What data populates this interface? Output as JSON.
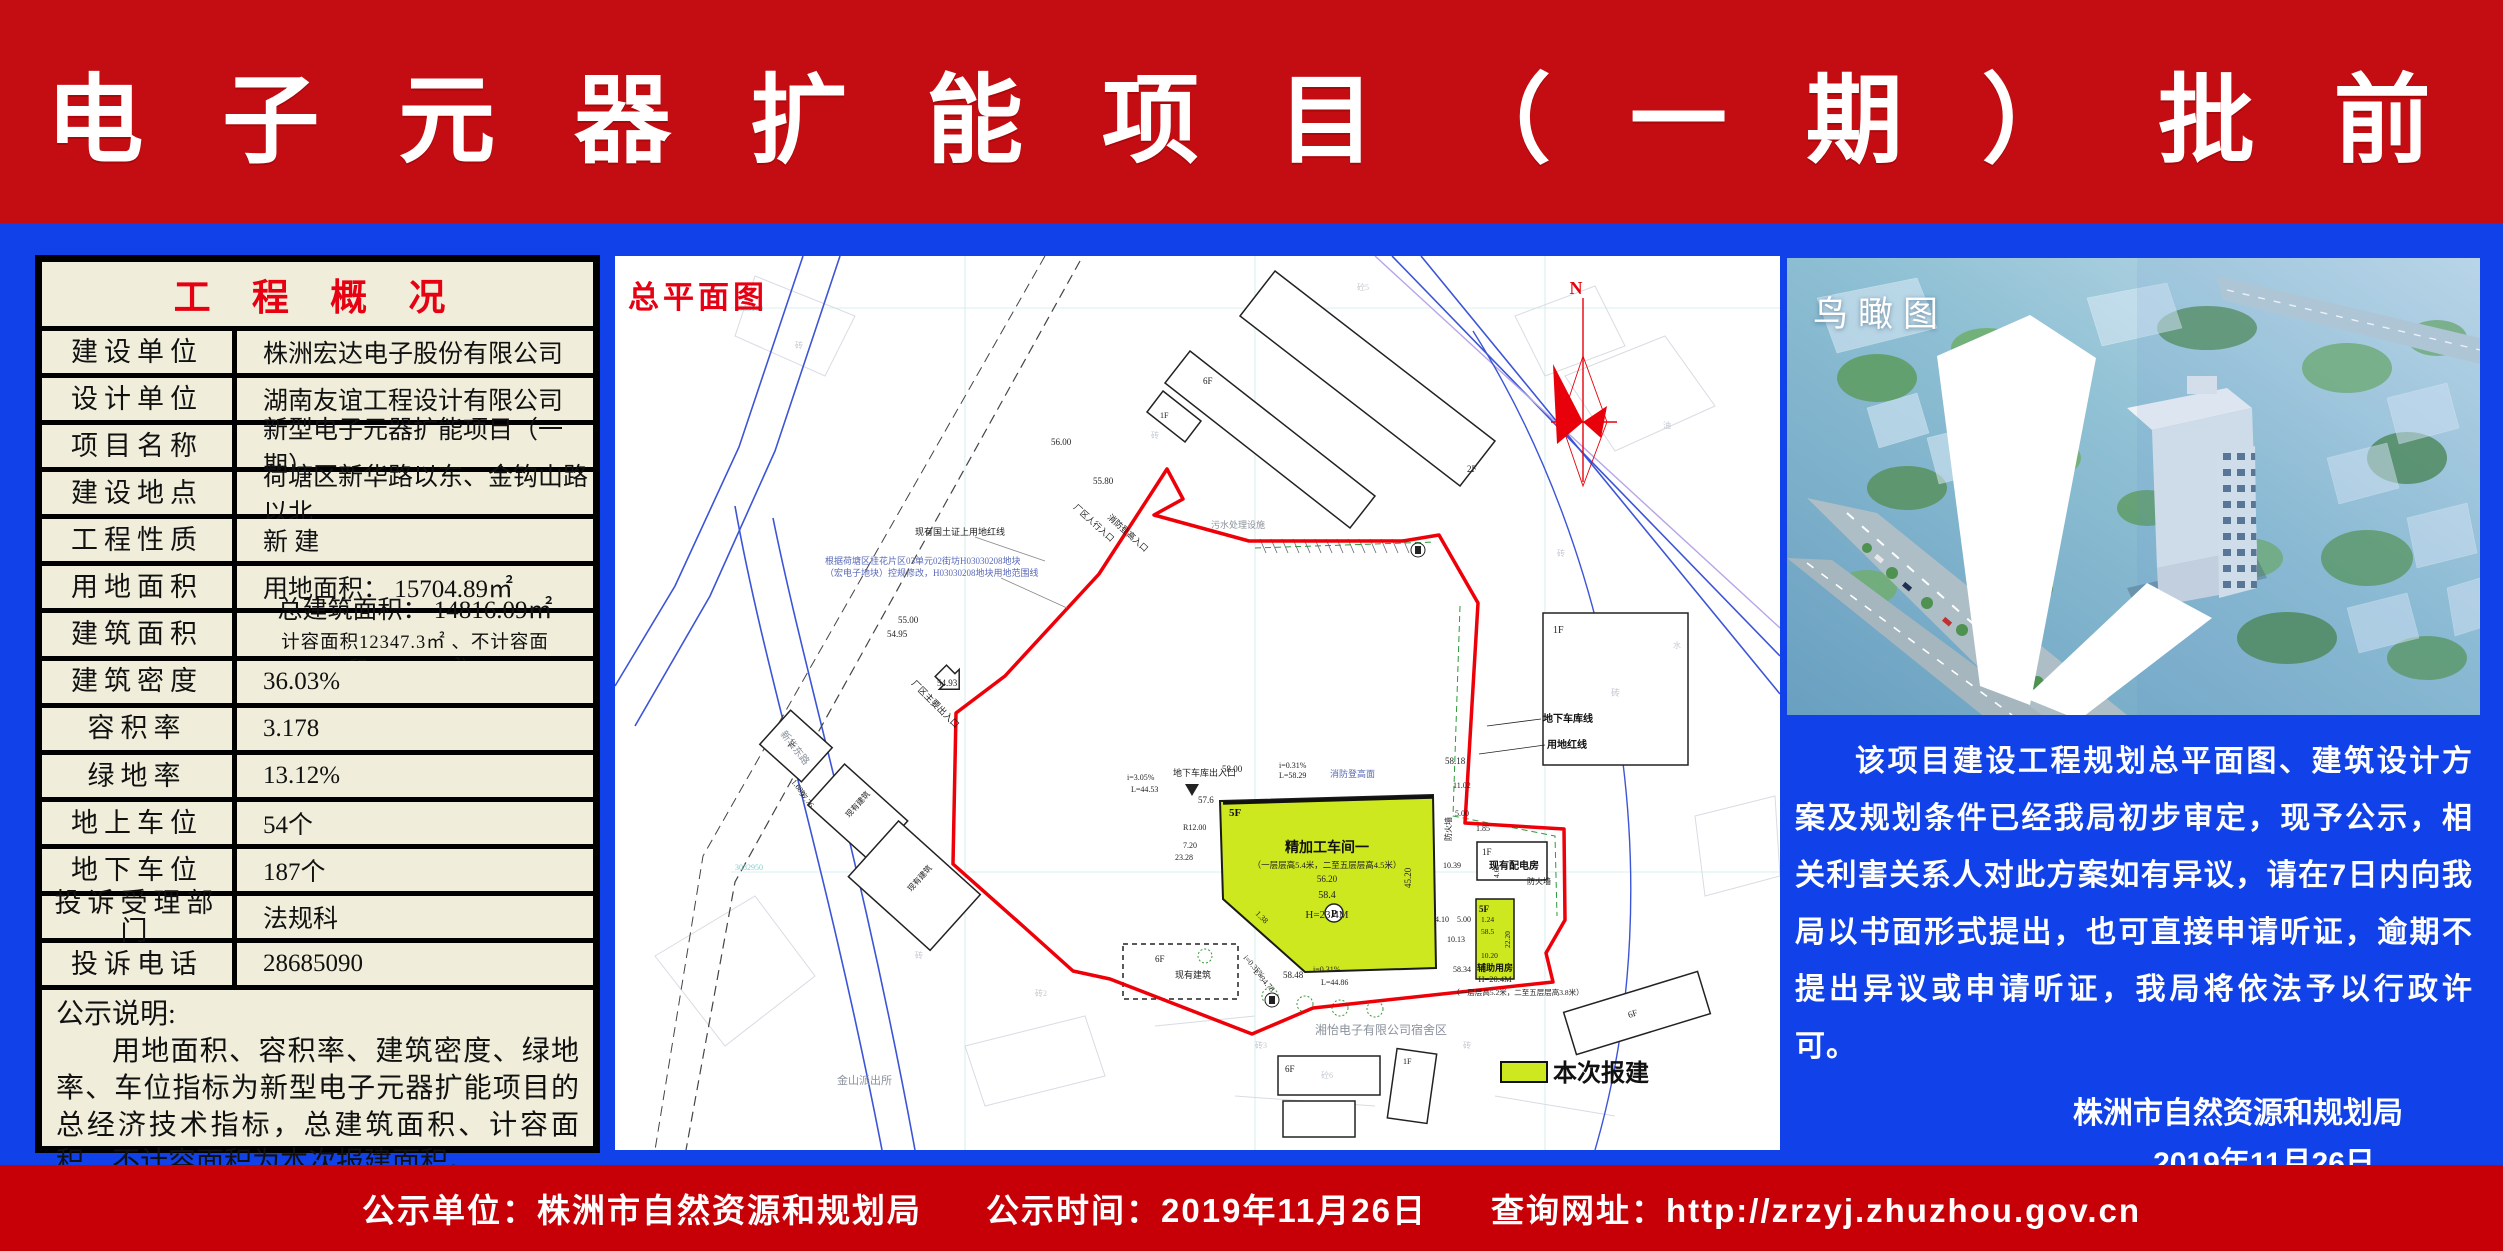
{
  "colors": {
    "banner_red": "#c40d12",
    "footer_red": "#c60006",
    "body_blue": "#1141e8",
    "table_bg": "#f0eedb",
    "accent_red": "#e60012",
    "plan_boundary_red": "#ee0008",
    "submission_yellow": "#cde81e"
  },
  "header": {
    "title": "新 型 电 子 元 器 扩 能 项 目 （ 一 期 ） 批 前 公 示"
  },
  "overview_table": {
    "title": "工 程 概 况",
    "rows": [
      {
        "label": "建设单位",
        "value": "株洲宏达电子股份有限公司"
      },
      {
        "label": "设计单位",
        "value": "湖南友谊工程设计有限公司"
      },
      {
        "label": "项目名称",
        "value": "新型电子元器扩能项目（一期）"
      },
      {
        "label": "建设地点",
        "value": "荷塘区新华路以东、金钩山路以北"
      },
      {
        "label": "工程性质",
        "value": "新 建"
      },
      {
        "label": "用地面积",
        "value": "用地面积： 15704.89㎡"
      },
      {
        "label": "建筑面积",
        "value": "总建筑面积： 14816.09㎡",
        "value2": "计容面积12347.3㎡ 、不计容面积:2468.79㎡）"
      },
      {
        "label": "建筑密度",
        "value": "36.03%"
      },
      {
        "label": "容积率",
        "value": "3.178"
      },
      {
        "label": "绿地率",
        "value": "13.12%"
      },
      {
        "label": "地上车位",
        "value": "54个"
      },
      {
        "label": "地下车位",
        "value": "187个"
      },
      {
        "label": "投诉受理部门",
        "value": "法规科"
      },
      {
        "label": "投诉电话",
        "value": "28685090"
      }
    ],
    "note_title": "公示说明:",
    "note_body": "用地面积、容积率、建筑密度、绿地率、车位指标为新型电子元器扩能项目的总经济技术指标，总建筑面积、计容面积、不计容面积为本次报建面积。"
  },
  "site_plan": {
    "panel_label": "总平面图",
    "legend_label": "本次报建",
    "annotations": [
      {
        "t": "N",
        "x": 961,
        "y": 38,
        "s": 18,
        "c": "rd",
        "a": "middle"
      },
      {
        "t": "精加工车间一",
        "x": 712,
        "y": 596,
        "s": 14,
        "c": "bld",
        "a": "middle"
      },
      {
        "t": "（一层层高5.4米，二至五层层高4.5米）",
        "x": 712,
        "y": 612,
        "s": 8.5,
        "c": "d",
        "a": "middle"
      },
      {
        "t": "56.20",
        "x": 712,
        "y": 626,
        "s": 9,
        "c": "d",
        "a": "middle"
      },
      {
        "t": "58.4",
        "x": 712,
        "y": 642,
        "s": 10,
        "c": "d",
        "a": "middle"
      },
      {
        "t": "H=23.4M",
        "x": 712,
        "y": 662,
        "s": 11,
        "c": "d",
        "a": "middle"
      },
      {
        "t": "5F",
        "x": 614,
        "y": 560,
        "s": 11,
        "c": "bld"
      },
      {
        "t": "5F",
        "x": 864,
        "y": 656,
        "s": 9,
        "c": "bld"
      },
      {
        "t": "1.24",
        "x": 866,
        "y": 666,
        "s": 7.5,
        "c": "d"
      },
      {
        "t": "58.5",
        "x": 866,
        "y": 678,
        "s": 7.5,
        "c": "d"
      },
      {
        "t": "10.20",
        "x": 866,
        "y": 702,
        "s": 7.5,
        "c": "d"
      },
      {
        "t": "22.20",
        "x": 895,
        "y": 692,
        "s": 7.5,
        "c": "d",
        "r": -90
      },
      {
        "t": "辅助用房",
        "x": 880,
        "y": 715,
        "s": 9,
        "c": "bld",
        "a": "middle"
      },
      {
        "t": "H=20.4M",
        "x": 880,
        "y": 726,
        "s": 8.5,
        "c": "d",
        "a": "middle"
      },
      {
        "t": "（一层层高5.2米，二至五层层高3.8米）",
        "x": 903,
        "y": 739,
        "s": 7.5,
        "c": "d",
        "a": "middle"
      },
      {
        "t": "1F",
        "x": 867,
        "y": 599,
        "s": 9,
        "c": "d"
      },
      {
        "t": "现有配电房",
        "x": 899,
        "y": 613,
        "s": 10,
        "c": "bld",
        "a": "middle"
      },
      {
        "t": "本次报建",
        "x": 938,
        "y": 825,
        "s": 24,
        "c": "lg"
      },
      {
        "t": "地下车库出入口",
        "x": 558,
        "y": 520,
        "s": 9,
        "c": "d"
      },
      {
        "t": "57.6",
        "x": 583,
        "y": 547,
        "s": 9,
        "c": "d"
      },
      {
        "t": "58.00",
        "x": 607,
        "y": 516,
        "s": 9,
        "c": "d"
      },
      {
        "t": "i=0.31%",
        "x": 664,
        "y": 512,
        "s": 8,
        "c": "d"
      },
      {
        "t": "L=58.29",
        "x": 664,
        "y": 522,
        "s": 8,
        "c": "d"
      },
      {
        "t": "消防登高面",
        "x": 715,
        "y": 521,
        "s": 9,
        "c": "blu"
      },
      {
        "t": "58.18",
        "x": 830,
        "y": 508,
        "s": 9,
        "c": "d"
      },
      {
        "t": "11.02",
        "x": 838,
        "y": 532,
        "s": 8,
        "c": "d"
      },
      {
        "t": "5.00",
        "x": 840,
        "y": 560,
        "s": 8,
        "c": "d"
      },
      {
        "t": "1.85",
        "x": 861,
        "y": 575,
        "s": 8,
        "c": "d"
      },
      {
        "t": "防火墙",
        "x": 836,
        "y": 585,
        "s": 8,
        "c": "d",
        "r": -90
      },
      {
        "t": "防火墙",
        "x": 912,
        "y": 628,
        "s": 8,
        "c": "d"
      },
      {
        "t": "10.39",
        "x": 828,
        "y": 612,
        "s": 8,
        "c": "d"
      },
      {
        "t": "4.66",
        "x": 884,
        "y": 622,
        "s": 7.5,
        "c": "d",
        "r": -90
      },
      {
        "t": "45.20",
        "x": 796,
        "y": 632,
        "s": 9,
        "c": "d",
        "r": -90
      },
      {
        "t": "4.10",
        "x": 820,
        "y": 666,
        "s": 8,
        "c": "d"
      },
      {
        "t": "5.00",
        "x": 842,
        "y": 666,
        "s": 8,
        "c": "d"
      },
      {
        "t": "10.13",
        "x": 832,
        "y": 686,
        "s": 8,
        "c": "d"
      },
      {
        "t": "58.34",
        "x": 838,
        "y": 716,
        "s": 8,
        "c": "d"
      },
      {
        "t": "58.48",
        "x": 668,
        "y": 722,
        "s": 9,
        "c": "d"
      },
      {
        "t": "i=0.31%",
        "x": 698,
        "y": 716,
        "s": 8,
        "c": "d"
      },
      {
        "t": "L=44.86",
        "x": 706,
        "y": 729,
        "s": 8,
        "c": "d"
      },
      {
        "t": "L=34.78",
        "x": 638,
        "y": 716,
        "s": 8,
        "c": "d",
        "r": 48
      },
      {
        "t": "i=0.35%",
        "x": 628,
        "y": 702,
        "s": 8,
        "c": "d",
        "r": 48
      },
      {
        "t": "7.20",
        "x": 568,
        "y": 592,
        "s": 8,
        "c": "d"
      },
      {
        "t": "1.38",
        "x": 640,
        "y": 658,
        "s": 8,
        "c": "d",
        "r": 45
      },
      {
        "t": "23.28",
        "x": 560,
        "y": 604,
        "s": 8,
        "c": "d"
      },
      {
        "t": "R12.00",
        "x": 568,
        "y": 574,
        "s": 8,
        "c": "d"
      },
      {
        "t": "i=3.05%",
        "x": 512,
        "y": 524,
        "s": 8,
        "c": "d"
      },
      {
        "t": "L=44.53",
        "x": 516,
        "y": 536,
        "s": 8,
        "c": "d"
      },
      {
        "t": "55.00",
        "x": 283,
        "y": 367,
        "s": 9,
        "c": "d"
      },
      {
        "t": "54.95",
        "x": 272,
        "y": 381,
        "s": 9,
        "c": "d"
      },
      {
        "t": "54.93",
        "x": 322,
        "y": 430,
        "s": 9,
        "c": "d"
      },
      {
        "t": "56.00",
        "x": 436,
        "y": 189,
        "s": 9,
        "c": "d"
      },
      {
        "t": "55.80",
        "x": 478,
        "y": 228,
        "s": 9,
        "c": "d"
      },
      {
        "t": "消防登高入口",
        "x": 492,
        "y": 262,
        "s": 8.5,
        "c": "d",
        "r": 42
      },
      {
        "t": "厂区人行入口",
        "x": 458,
        "y": 252,
        "s": 8.5,
        "c": "d",
        "r": 42
      },
      {
        "t": "厂区主要出入口",
        "x": 296,
        "y": 428,
        "s": 9,
        "c": "d",
        "r": 45
      },
      {
        "t": "现有国土证上用地红线",
        "x": 300,
        "y": 279,
        "s": 9,
        "c": "d"
      },
      {
        "t": "根据荷塘区桂花片区03单元02街坊H03030208地块",
        "x": 210,
        "y": 308,
        "s": 9,
        "c": "blu"
      },
      {
        "t": "（宏电子地块）控规修改，H03030208地块用地范围线",
        "x": 210,
        "y": 320,
        "s": 9,
        "c": "blu"
      },
      {
        "t": "地下车库线",
        "x": 928,
        "y": 466,
        "s": 10,
        "c": "bld"
      },
      {
        "t": "用地红线",
        "x": 932,
        "y": 492,
        "s": 10,
        "c": "bld"
      },
      {
        "t": "污水处理设施",
        "x": 596,
        "y": 272,
        "s": 9,
        "c": "g"
      },
      {
        "t": "湘怡电子有限公司宿舍区",
        "x": 700,
        "y": 778,
        "s": 12,
        "c": "g"
      },
      {
        "t": "金山派出所",
        "x": 222,
        "y": 828,
        "s": 11,
        "c": "g"
      },
      {
        "t": "新华东路",
        "x": 165,
        "y": 478,
        "s": 10,
        "c": "g",
        "r": 52
      },
      {
        "t": "1.68%",
        "x": 176,
        "y": 526,
        "s": 8,
        "c": "d",
        "r": 52
      },
      {
        "t": "97.76",
        "x": 184,
        "y": 538,
        "s": 8,
        "c": "d",
        "r": 52
      },
      {
        "t": "现有建筑",
        "x": 234,
        "y": 562,
        "s": 8,
        "c": "d",
        "r": -48
      },
      {
        "t": "现有建筑",
        "x": 296,
        "y": 636,
        "s": 8,
        "c": "d",
        "r": -48
      },
      {
        "t": "7F",
        "x": 176,
        "y": 494,
        "s": 8,
        "c": "d",
        "r": -48
      },
      {
        "t": "6F",
        "x": 540,
        "y": 706,
        "s": 9,
        "c": "d"
      },
      {
        "t": "现有建筑",
        "x": 560,
        "y": 722,
        "s": 9,
        "c": "d"
      },
      {
        "t": "6F",
        "x": 588,
        "y": 128,
        "s": 9,
        "c": "d"
      },
      {
        "t": "2F",
        "x": 852,
        "y": 216,
        "s": 9,
        "c": "d"
      },
      {
        "t": "1F",
        "x": 545,
        "y": 162,
        "s": 8,
        "c": "d"
      },
      {
        "t": "1F",
        "x": 938,
        "y": 377,
        "s": 10,
        "c": "d"
      },
      {
        "t": "砖",
        "x": 996,
        "y": 440,
        "s": 9,
        "c": "g2"
      },
      {
        "t": "6F",
        "x": 670,
        "y": 816,
        "s": 9,
        "c": "d"
      },
      {
        "t": "砼6",
        "x": 706,
        "y": 822,
        "s": 8,
        "c": "g2"
      },
      {
        "t": "1F",
        "x": 788,
        "y": 808,
        "s": 8,
        "c": "d"
      },
      {
        "t": "6F",
        "x": 1014,
        "y": 762,
        "s": 9,
        "c": "d",
        "r": -17
      },
      {
        "t": "P",
        "x": 719,
        "y": 661,
        "s": 10,
        "c": "bld",
        "a": "middle"
      },
      {
        "t": "3083100",
        "x": 120,
        "y": 55,
        "s": 8,
        "c": "cy"
      },
      {
        "t": "3082950",
        "x": 120,
        "y": 614,
        "s": 8,
        "c": "cy"
      },
      {
        "t": "砖",
        "x": 180,
        "y": 92,
        "s": 8,
        "c": "g2"
      },
      {
        "t": "砼5",
        "x": 742,
        "y": 34,
        "s": 8,
        "c": "g2"
      },
      {
        "t": "砖",
        "x": 536,
        "y": 182,
        "s": 8,
        "c": "g2"
      },
      {
        "t": "砖",
        "x": 942,
        "y": 300,
        "s": 8,
        "c": "g2"
      },
      {
        "t": "油",
        "x": 1048,
        "y": 172,
        "s": 8,
        "c": "g2"
      },
      {
        "t": "水",
        "x": 1058,
        "y": 392,
        "s": 8,
        "c": "g2"
      },
      {
        "t": "砖",
        "x": 300,
        "y": 702,
        "s": 8,
        "c": "g2"
      },
      {
        "t": "砖",
        "x": 848,
        "y": 792,
        "s": 8,
        "c": "g2"
      },
      {
        "t": "砖2",
        "x": 420,
        "y": 740,
        "s": 8,
        "c": "g2"
      },
      {
        "t": "砖3",
        "x": 640,
        "y": 792,
        "s": 8,
        "c": "g2"
      }
    ]
  },
  "aerial": {
    "panel_label": "鸟瞰图"
  },
  "notice": {
    "paragraph": "该项目建设工程规划总平面图、建筑设计方案及规划条件已经我局初步审定，现予公示，相关利害关系人对此方案如有异议，请在7日内向我局以书面形式提出，也可直接申请听证，逾期不提出异议或申请听证，我局将依法予以行政许可。",
    "signature_org": "株洲市自然资源和规划局",
    "signature_date": "2019年11月26日"
  },
  "footer": {
    "items": [
      "公示单位：株洲市自然资源和规划局",
      "公示时间：2019年11月26日",
      "查询网址：http://zrzyj.zhuzhou.gov.cn"
    ]
  }
}
